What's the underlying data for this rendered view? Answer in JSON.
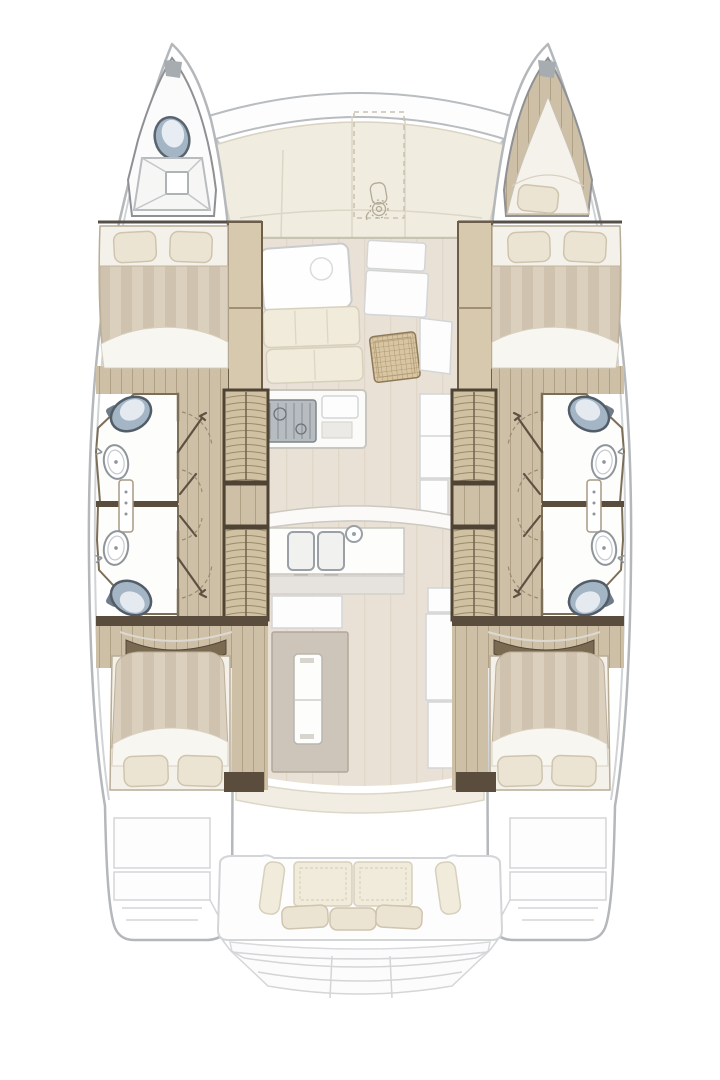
{
  "meta": {
    "description": "Overhead interior deck plan of a sailing catamaran",
    "view": "top-down floorplan, bows at top, transom at bottom"
  },
  "palette": {
    "hull_outline": "#b4b8bb",
    "toe_line": "#d0d4d6",
    "deck_cream": "#f0ecdf",
    "deck_seam": "#dcd6c5",
    "floor_beige": "#e9e1d5",
    "floor_streak": "#e0d7c9",
    "wood": "#cdc0a7",
    "wood_line": "#b0a084",
    "wood_frame": "#4f4334",
    "bulkhead": "#5b4d3d",
    "wall_brown": "#7d6e58",
    "wardrobe": "#d6c9ad",
    "duvet_a": "#dbd0be",
    "duvet_b": "#cfc2ae",
    "sheet": "#f8f6f1",
    "pillow": "#ece4d2",
    "pillow_line": "#cfc4ae",
    "cushion": "#f1ebdc",
    "cushion_line": "#d7d0bc",
    "toilet": "#a4b6c6",
    "toilet_dark": "#55616d",
    "fixture_line": "#9aa0a5",
    "white_fill": "#fdfdfd",
    "gray_line": "#d3d5d7",
    "stove": "#b7bcc1",
    "stove_line": "#7e848b",
    "rattan_bg": "#d8c5a2",
    "rattan_line": "#a68e66",
    "tread_bg": "#cfc1a2",
    "tread_line": "#9b8b6d",
    "island_taupe": "#cdc5b9",
    "door_arc": "#9a8a70",
    "background": "#ffffff"
  },
  "vessel": {
    "type": "catamaran",
    "counts": {
      "double_berths": 4,
      "bow_v_berth": 1,
      "heads_compartments": 4,
      "toilets": 5,
      "washbasins": 4,
      "stair_flights": 4
    },
    "port_hull": {
      "bow": [
        "crew toilet",
        "foredeck hatch with cross bracing"
      ],
      "forward_cabin": "double berth, two pillows, striped duvet, wardrobe inboard",
      "forward_head": "toilet and oval washbasin, door to corridor",
      "aft_head": "toilet and oval washbasin, door to corridor",
      "companionway": "two stair flights with wood landing",
      "aft_cabin": "double berth, two pillows, curved headboard"
    },
    "starboard_hull": {
      "bow": [
        "v-berth cushion with pillow"
      ],
      "forward_cabin": "double berth, two pillows, striped duvet, wardrobe inboard",
      "forward_head": "toilet and oval washbasin, door to corridor",
      "aft_head": "toilet and oval washbasin, door to corridor",
      "companionway": "two stair flights with wood landing",
      "aft_cabin": "double berth, two pillows, curved headboard"
    },
    "bridgedeck": {
      "foredeck": "cream deck panels, dashed anchor-locker outline with windlass",
      "salon": [
        "dining table with round detail",
        "settee cushions",
        "rattan stool",
        "side cabinets"
      ],
      "galley": [
        "gas stove",
        "double sink with round faucet",
        "curved island counter",
        "taupe aft island with tall locker"
      ]
    },
    "cockpit": {
      "bench": "aft-facing sofa with two stitched back cushions, two side bolsters, three throw pillows",
      "transom": "curved swim steps between hull sterns"
    }
  }
}
